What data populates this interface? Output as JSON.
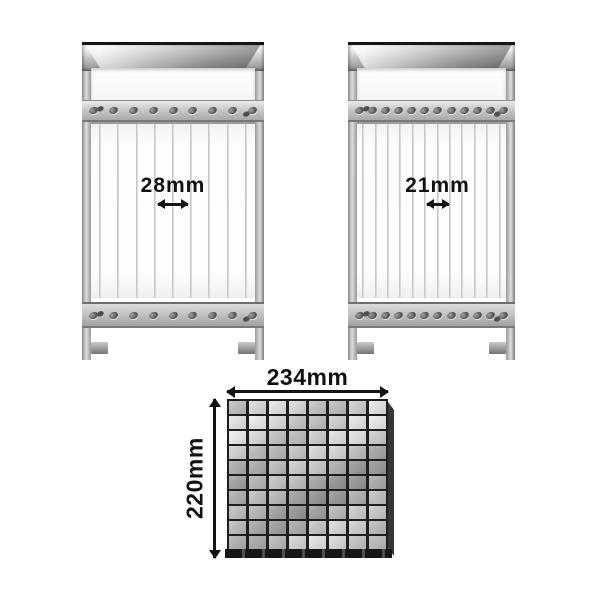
{
  "frames": [
    {
      "spacing_label": "28mm",
      "wire_count": 9,
      "screw_count": 9
    },
    {
      "spacing_label": "21mm",
      "wire_count": 12,
      "screw_count": 12
    }
  ],
  "base_grid": {
    "width_label": "234mm",
    "height_label": "220mm",
    "columns": 8,
    "rows": 10
  },
  "colors": {
    "background": "#ffffff",
    "annotation_text": "#121212",
    "chrome_light": "#eaeaea",
    "chrome_mid": "#bcbcbc",
    "chrome_dark": "#8e8e8e",
    "grid_line": "#1f1e1c"
  }
}
